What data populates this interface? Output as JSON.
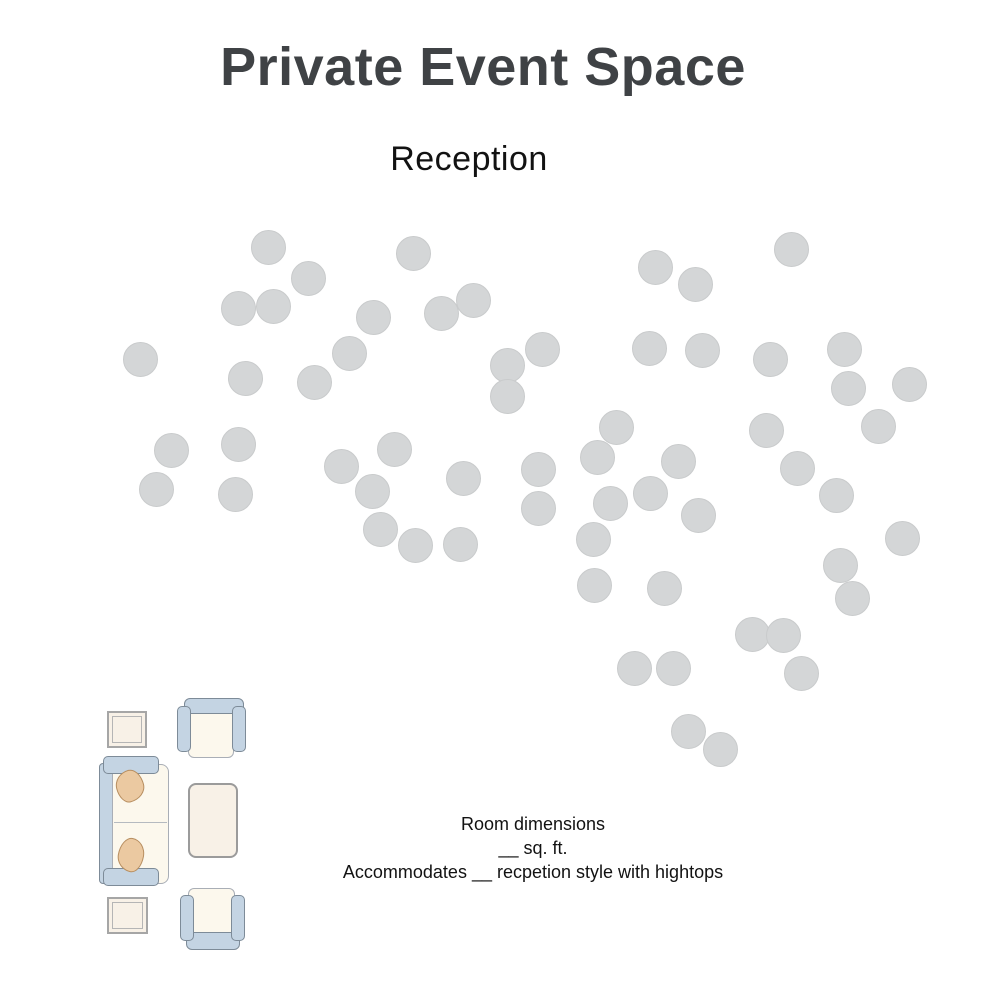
{
  "page": {
    "title": "Private Event Space",
    "subtitle": "Reception"
  },
  "caption": {
    "line1": "Room dimensions",
    "line2": "__ sq. ft.",
    "line3": "Accommodates __  recpetion style with hightops"
  },
  "colors": {
    "background": "#ffffff",
    "title_text": "#3f4245",
    "body_text": "#121212",
    "dot_fill": "#d4d6d7",
    "dot_edge": "#c9cbcc",
    "furniture_blue": "#c4d4e3",
    "furniture_outline": "#7d8b98",
    "seat_cream": "#fcf8ed",
    "seat_outline": "#a9aeb6",
    "table_cream": "#f8f1e7",
    "table_outline": "#a6a6a6",
    "pillow_tan": "#ebc9a1",
    "pillow_outline": "#b78e60"
  },
  "floor_plan": {
    "dot_diameter": 35,
    "dot_count": 60,
    "dots": [
      [
        268,
        247
      ],
      [
        308,
        278
      ],
      [
        238,
        308
      ],
      [
        273,
        306
      ],
      [
        413,
        253
      ],
      [
        373,
        317
      ],
      [
        441,
        313
      ],
      [
        473,
        300
      ],
      [
        140,
        359
      ],
      [
        349,
        353
      ],
      [
        245,
        378
      ],
      [
        314,
        382
      ],
      [
        171,
        450
      ],
      [
        238,
        444
      ],
      [
        156,
        489
      ],
      [
        235,
        494
      ],
      [
        507,
        365
      ],
      [
        542,
        349
      ],
      [
        507,
        396
      ],
      [
        394,
        449
      ],
      [
        341,
        466
      ],
      [
        372,
        491
      ],
      [
        463,
        478
      ],
      [
        538,
        469
      ],
      [
        538,
        508
      ],
      [
        380,
        529
      ],
      [
        415,
        545
      ],
      [
        460,
        544
      ],
      [
        655,
        267
      ],
      [
        695,
        284
      ],
      [
        791,
        249
      ],
      [
        649,
        348
      ],
      [
        702,
        350
      ],
      [
        770,
        359
      ],
      [
        844,
        349
      ],
      [
        848,
        388
      ],
      [
        909,
        384
      ],
      [
        878,
        426
      ],
      [
        616,
        427
      ],
      [
        597,
        457
      ],
      [
        678,
        461
      ],
      [
        766,
        430
      ],
      [
        797,
        468
      ],
      [
        836,
        495
      ],
      [
        610,
        503
      ],
      [
        650,
        493
      ],
      [
        698,
        515
      ],
      [
        593,
        539
      ],
      [
        594,
        585
      ],
      [
        664,
        588
      ],
      [
        902,
        538
      ],
      [
        840,
        565
      ],
      [
        852,
        598
      ],
      [
        752,
        634
      ],
      [
        783,
        635
      ],
      [
        801,
        673
      ],
      [
        634,
        668
      ],
      [
        673,
        668
      ],
      [
        688,
        731
      ],
      [
        720,
        749
      ]
    ],
    "furniture_items": [
      "square-side-table",
      "armchair",
      "sofa",
      "coffee-table",
      "armchair",
      "square-side-table"
    ]
  }
}
